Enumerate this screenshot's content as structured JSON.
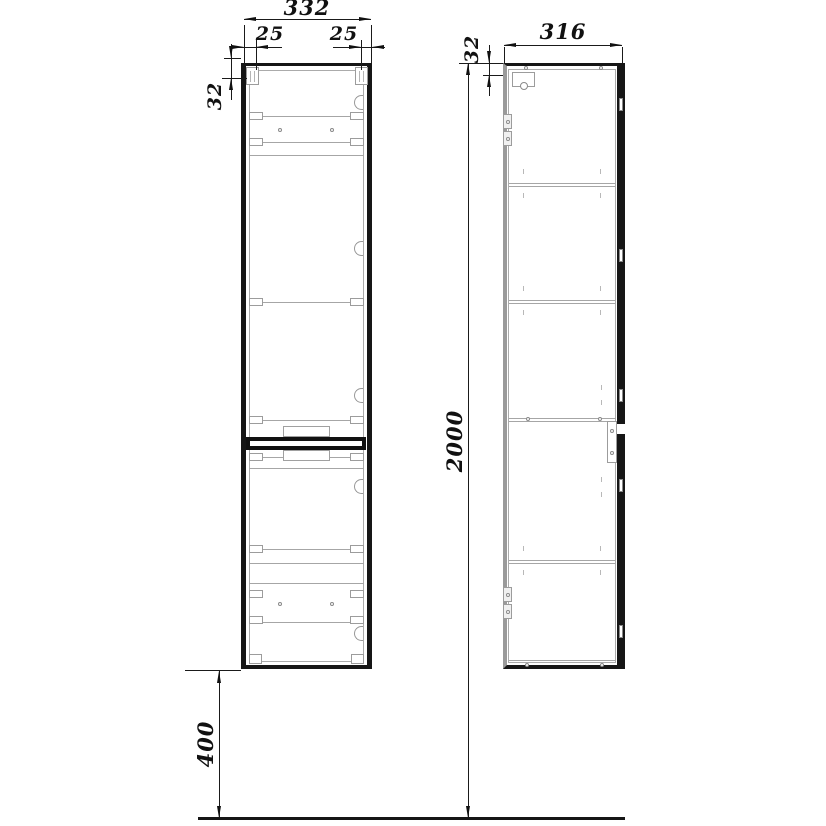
{
  "drawing": {
    "type": "furniture technical drawing - tall wall-hung cabinet, front and side views",
    "dimensions": {
      "front_width": "332",
      "left_bracket_offset": "25",
      "right_bracket_offset": "25",
      "front_top_inset": "32",
      "side_depth": "316",
      "side_top_inset": "32",
      "overall_height": "2000",
      "floor_clearance": "400"
    },
    "colors": {
      "line": "#161616",
      "detail": "#9c9c9c",
      "background": "#ffffff"
    }
  }
}
